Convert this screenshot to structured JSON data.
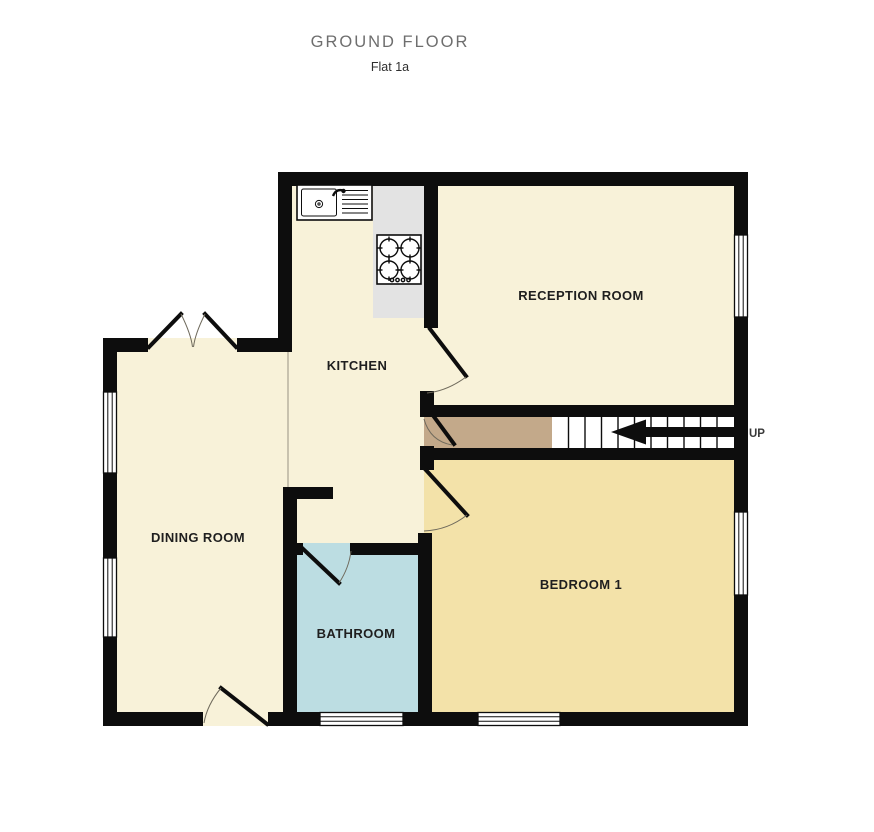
{
  "title": "GROUND FLOOR",
  "subtitle": "Flat 1a",
  "rooms": [
    {
      "id": "kitchen",
      "label": "KITCHEN"
    },
    {
      "id": "reception",
      "label": "RECEPTION ROOM"
    },
    {
      "id": "dining",
      "label": "DINING ROOM"
    },
    {
      "id": "bathroom",
      "label": "BATHROOM"
    },
    {
      "id": "bedroom",
      "label": "BEDROOM 1"
    }
  ],
  "stairs": {
    "direction_label": "UP"
  },
  "fixtures": [
    {
      "id": "sink-drainer-icon",
      "description": "kitchen sink with drainer"
    },
    {
      "id": "hob-4-burner-icon",
      "description": "4-ring hob"
    },
    {
      "id": "up-arrow-icon",
      "description": "staircase direction arrow"
    }
  ],
  "colors": {
    "cream": "#f8f2d9",
    "bedroom": "#f3e2a9",
    "bathroom": "#bcdde2",
    "hall": "#c3a98a",
    "counter": "#e3e3e3",
    "wall": "#0d0d0d",
    "title": "#6e6e6e",
    "label": "#1f1f1f"
  }
}
